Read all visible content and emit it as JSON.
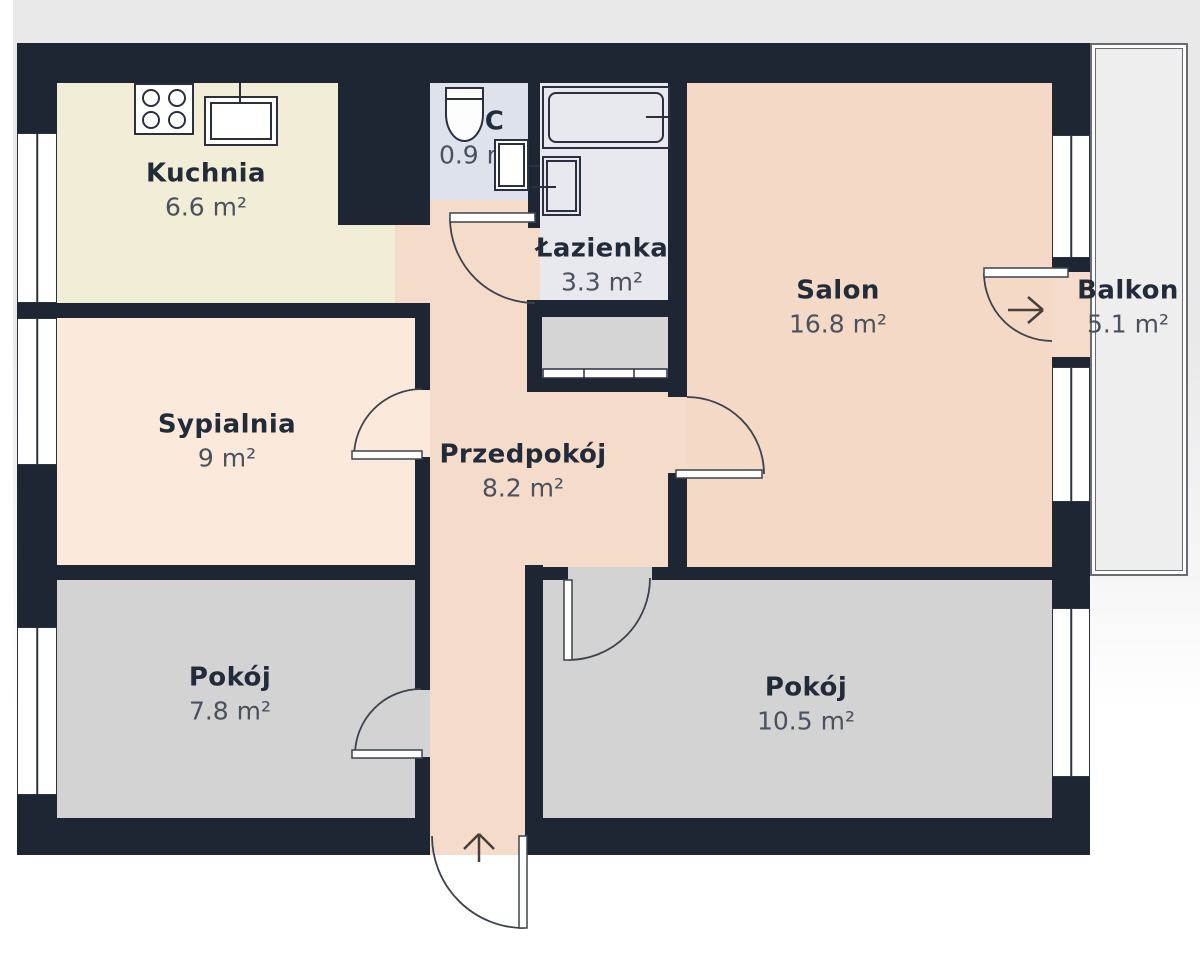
{
  "title": "Apartment floor plan",
  "rooms": [
    {
      "name": "Kuchnia",
      "area": "6.6 m²"
    },
    {
      "name": "WC",
      "area": "0.9 m²"
    },
    {
      "name": "Łazienka",
      "area": "3.3 m²"
    },
    {
      "name": "Salon",
      "area": "16.8 m²"
    },
    {
      "name": "Balkon",
      "area": "5.1 m²"
    },
    {
      "name": "Sypialnia",
      "area": "9 m²"
    },
    {
      "name": "Przedpokój",
      "area": "8.2 m²"
    },
    {
      "name": "Pokój",
      "area": "7.8 m²"
    },
    {
      "name": "Pokój",
      "area": "10.5 m²"
    }
  ],
  "colors": {
    "wall": "#1e2634",
    "kitchen_floor": "#f2edd6",
    "bedroom_floor": "#fbeadb",
    "living_floor": "#f4d9c6",
    "hall_floor": "#f5dbca",
    "wc_floor": "#dde2ec",
    "bath_floor": "#e7e9ee",
    "room_floor": "#d3d3d4",
    "wardrobe_floor": "#d5d5d6",
    "balcony_floor": "#eeeeef",
    "background": "#e9e9ea",
    "line": "#3c434e"
  }
}
